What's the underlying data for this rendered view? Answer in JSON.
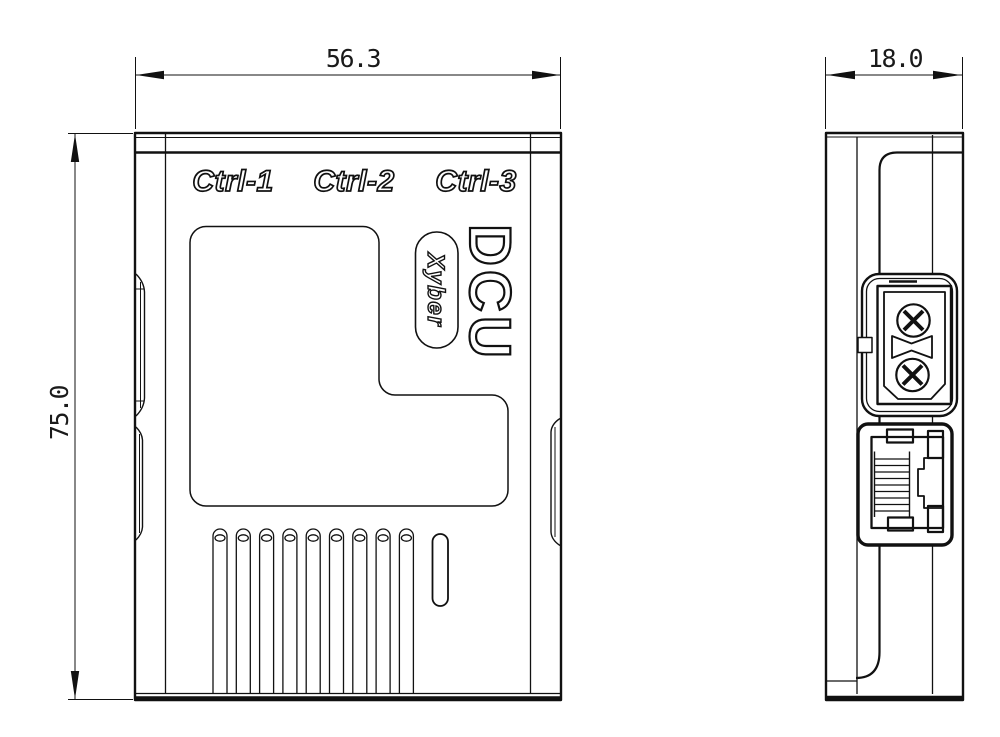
{
  "title": "DCU enclosure technical drawing",
  "labels": {
    "ports": [
      "Ctrl-1",
      "Ctrl-2",
      "Ctrl-3"
    ],
    "model": "DCU",
    "brand": "Xyber"
  },
  "dimensions": {
    "front_width": "56.3",
    "front_height": "75.0",
    "side_depth": "18.0"
  },
  "colors": {
    "line": "#111111",
    "background": "#ffffff"
  }
}
